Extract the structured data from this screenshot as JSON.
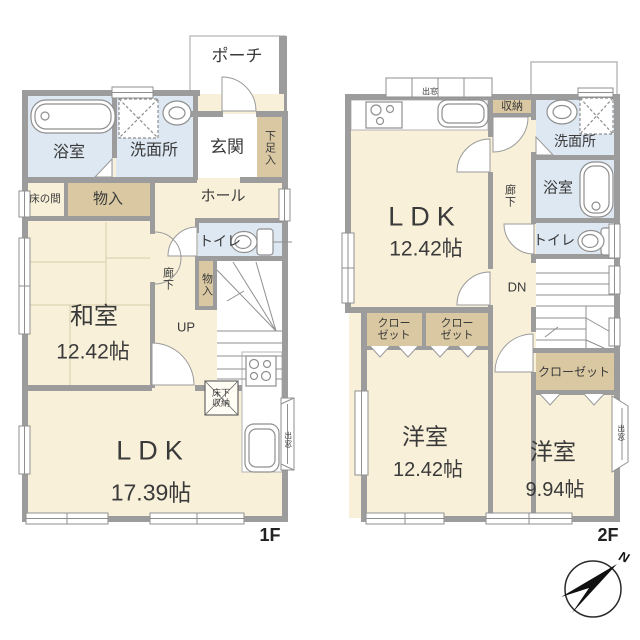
{
  "floor1": {
    "label": "1F",
    "rooms": {
      "porch": "ポーチ",
      "entrance": "玄関",
      "shoe_storage": "下足入",
      "bathroom": "浴室",
      "washroom": "洗面所",
      "tokonoma": "床の間",
      "storage_hall": "物入",
      "hall": "ホール",
      "toilet": "トイレ",
      "corridor": "廊下",
      "storage_stairs": "物入",
      "stairs_up": "UP",
      "japanese_room": "和室",
      "japanese_room_size": "12.42帖",
      "ldk": "LDK",
      "ldk_size": "17.39帖",
      "underfloor_line1": "床下",
      "underfloor_line2": "収納",
      "bay_window": "出窓"
    }
  },
  "floor2": {
    "label": "2F",
    "rooms": {
      "ldk": "LDK",
      "ldk_size": "12.42帖",
      "storage": "収納",
      "bay_window_top": "出窓",
      "washroom": "洗面所",
      "bathroom": "浴室",
      "toilet": "トイレ",
      "corridor": "廊下",
      "stairs_down": "DN",
      "closet_left_line1": "クロー",
      "closet_left_line2": "ゼット",
      "closet_mid_line1": "クロー",
      "closet_mid_line2": "ゼット",
      "closet_right": "クローゼット",
      "western_room1": "洋室",
      "western_room1_size": "12.42帖",
      "western_room2": "洋室",
      "western_room2_size": "9.94帖",
      "bay_window_right": "出窓"
    }
  },
  "compass": {
    "north": "N"
  },
  "colors": {
    "room_cream": "#f8f0d9",
    "storage_tan": "#d9c8a2",
    "water_blue": "#dde8f2",
    "wall_gray": "#9c9c9c"
  }
}
